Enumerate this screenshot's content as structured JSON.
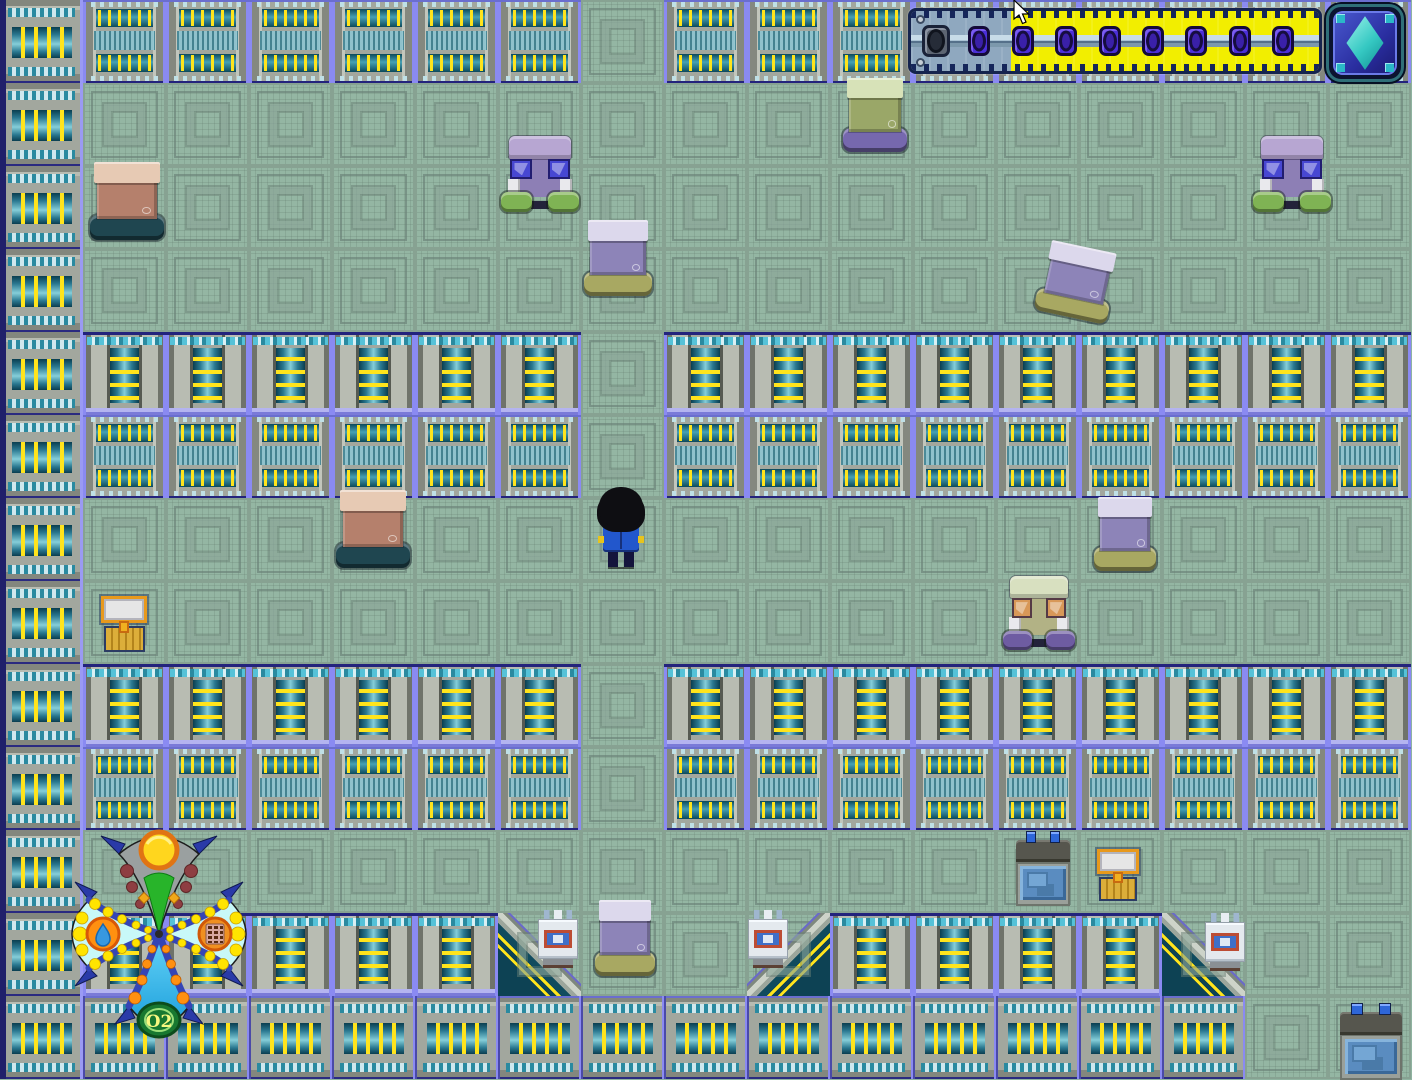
{
  "meta": {
    "width": 1412,
    "height": 1080
  },
  "colors": {
    "floor": "#94b6a3",
    "floor_line": "#6e8a7e",
    "wall_gray": "#a2a79e",
    "teal_dark": "#0c4a5c",
    "teal_light": "#85ced9",
    "coil_yellow": "#ffe41c",
    "separator_purple": "#8a8af2",
    "separator_navy": "#23237c",
    "bar_yellow": "#f2ee00",
    "bar_gray": "#8fa8bf",
    "gem_purple": "#4b2fd8",
    "diamond_teal": "#4fe0d4"
  },
  "map": {
    "tile_size": 83,
    "cols": 17,
    "rows": 13,
    "legend": {
      "F": "floor",
      "W": "wall-bars",
      "C": "wall-cylinder",
      "R": "wall-cylinder",
      "V": "wall-coil",
      "E": "wall-edge",
      "L": "corner-wall-lower-left",
      "J": "corner-wall-lower-right"
    },
    "grid": [
      "EWWWWWWFWWWWWWWWW",
      "EFFFFFFFFFFFFFFFF",
      "EFFFFFFFFFFFFFFFF",
      "EFFFFFFFFFFFFFFFF",
      "ECCCCCCFCCCCCCCCC",
      "EWWWWWWFWWWWWWWWW",
      "EFFFFFFFFFFFFFFFF",
      "EFFFFFFFFFFFFFFFF",
      "ECCCCCCFCCCCCCCCC",
      "EWWWWWWFWWWWWWWWW",
      "EFFFFFFFFFFFFFFFF",
      "ERRRRRLFFJRRRRLFF",
      "EVVVVVVVVVVVVVVFF"
    ]
  },
  "bed_variants": {
    "brown": {
      "pillow": "#e7cab4",
      "blanket": "#b5806c",
      "base": "#1f4650"
    },
    "purple": {
      "pillow": "#dcd8ec",
      "blanket": "#8d84b8",
      "base": "#a8a862"
    },
    "olive": {
      "pillow": "#d7e2b8",
      "blanket": "#9aa768",
      "base": "#7668ae"
    }
  },
  "healer_variants": {
    "blue": {
      "slab": "#b7a6d2",
      "body": "#8d7fb5",
      "screen": "#4747d2",
      "pad": "#7fb354"
    },
    "tan": {
      "slab": "#d8e0c0",
      "body": "#b2b285",
      "screen": "#d89858",
      "pad": "#6e5ca2"
    }
  },
  "sprites": [
    {
      "type": "bed",
      "variant": "brown",
      "x": 90,
      "y": 162,
      "w": 74,
      "h": 78
    },
    {
      "type": "healer",
      "variant": "blue",
      "x": 501,
      "y": 136,
      "w": 78,
      "h": 76
    },
    {
      "type": "bed",
      "variant": "purple",
      "x": 584,
      "y": 220,
      "w": 68,
      "h": 76
    },
    {
      "type": "bed",
      "variant": "olive",
      "x": 843,
      "y": 78,
      "w": 64,
      "h": 74
    },
    {
      "type": "healer",
      "variant": "blue",
      "x": 1253,
      "y": 136,
      "w": 78,
      "h": 76
    },
    {
      "type": "bed",
      "variant": "purple",
      "x": 1040,
      "y": 246,
      "w": 74,
      "h": 72,
      "tilt": 12
    },
    {
      "type": "bed",
      "variant": "brown",
      "x": 336,
      "y": 490,
      "w": 74,
      "h": 78
    },
    {
      "type": "bed",
      "variant": "purple",
      "x": 1094,
      "y": 497,
      "w": 62,
      "h": 74
    },
    {
      "type": "healer",
      "variant": "tan",
      "x": 1003,
      "y": 576,
      "w": 72,
      "h": 74
    },
    {
      "type": "chest",
      "x": 99,
      "y": 596,
      "w": 50,
      "h": 56
    },
    {
      "type": "pc",
      "x": 1016,
      "y": 832,
      "w": 54,
      "h": 74
    },
    {
      "type": "chest",
      "x": 1095,
      "y": 849,
      "w": 46,
      "h": 52
    },
    {
      "type": "console",
      "x": 538,
      "y": 910,
      "w": 40,
      "h": 58
    },
    {
      "type": "bed",
      "variant": "purple",
      "x": 595,
      "y": 900,
      "w": 60,
      "h": 76
    },
    {
      "type": "console",
      "x": 748,
      "y": 910,
      "w": 40,
      "h": 58
    },
    {
      "type": "console",
      "x": 1205,
      "y": 913,
      "w": 40,
      "h": 58
    },
    {
      "type": "pc",
      "x": 1340,
      "y": 1004,
      "w": 62,
      "h": 76
    }
  ],
  "player": {
    "x": 597,
    "y": 487,
    "w": 48,
    "h": 80
  },
  "hud": {
    "bar": {
      "x": 908,
      "y": 4,
      "width": 414,
      "height": 74,
      "gray_width": 100,
      "slots": [
        "socket",
        "gem",
        "gem",
        "gem",
        "gem",
        "gem",
        "gem",
        "gem",
        "gem"
      ],
      "first_gem_center": 25,
      "gem_spacing": 43.4
    },
    "button": {
      "x": 1326,
      "y": 4,
      "size": 78,
      "icon": "diamond-gem"
    },
    "o2_gauge": {
      "x": 43,
      "y": 808,
      "width": 232,
      "height": 252,
      "label": "O2",
      "north_icon": "sun",
      "west_icon": "water-drop",
      "east_icon": "food-bar",
      "south_icon": "oxygen-label"
    },
    "cursor": {
      "x": 1012,
      "y": 0
    }
  }
}
